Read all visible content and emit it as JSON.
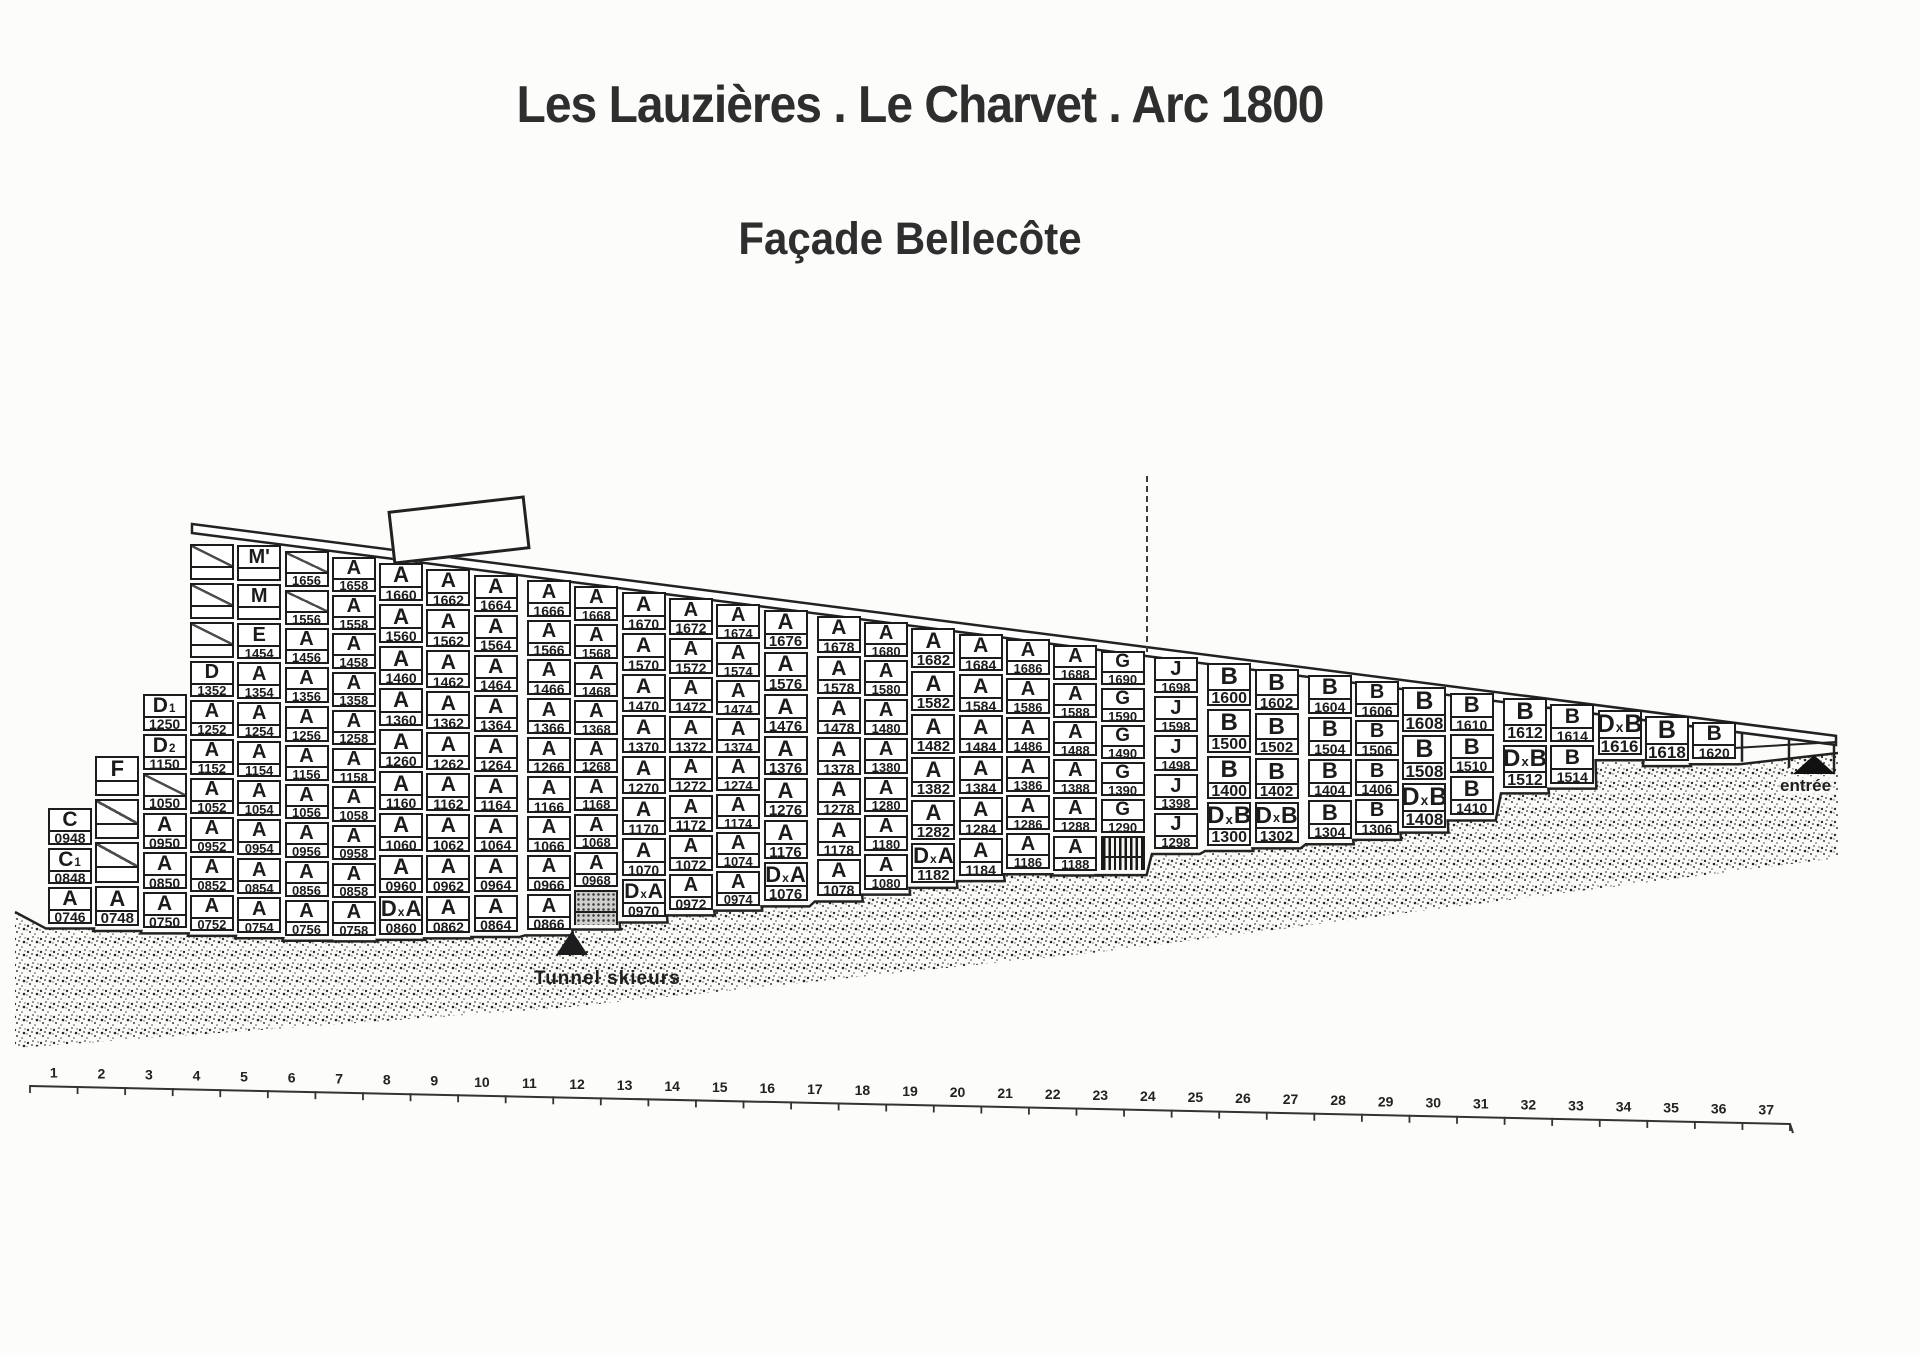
{
  "title": "Les Lauzières . Le Charvet . Arc 1800",
  "subtitle": "Façade Bellecôte",
  "annotations": {
    "tunnel_label": "Tunnel skieurs",
    "entree_label": "entrée"
  },
  "ruler": {
    "first": 1,
    "last": 37
  },
  "building": {
    "name": "Façade Bellecôte unit grid",
    "columns": [
      {
        "id": "46",
        "cells": [
          {
            "t": "C",
            "n": "0948"
          },
          {
            "t": "C1",
            "n": "0848"
          },
          {
            "t": "A",
            "n": "0746"
          }
        ]
      },
      {
        "id": "48",
        "cells": [
          {
            "t": "F",
            "n": ""
          },
          {
            "t": "",
            "n": "",
            "d": 1
          },
          {
            "t": "",
            "n": "",
            "d": 1
          },
          {
            "t": "A",
            "n": "0748"
          }
        ]
      },
      {
        "id": "50",
        "cells": [
          {
            "t": "D1",
            "n": "1250"
          },
          {
            "t": "D2",
            "n": "1150"
          },
          {
            "t": "",
            "n": "1050",
            "d": 1
          },
          {
            "t": "A",
            "n": "0950"
          },
          {
            "t": "A",
            "n": "0850"
          },
          {
            "t": "A",
            "n": "0750"
          }
        ]
      },
      {
        "id": "52",
        "cells": [
          {
            "t": "",
            "n": "",
            "d": 1
          },
          {
            "t": "",
            "n": "",
            "d": 1
          },
          {
            "t": "",
            "n": "",
            "d": 1
          },
          {
            "t": "D",
            "n": "1352"
          },
          {
            "t": "A",
            "n": "1252"
          },
          {
            "t": "A",
            "n": "1152"
          },
          {
            "t": "A",
            "n": "1052"
          },
          {
            "t": "A",
            "n": "0952"
          },
          {
            "t": "A",
            "n": "0852"
          },
          {
            "t": "A",
            "n": "0752"
          }
        ]
      },
      {
        "id": "54",
        "cells": [
          {
            "t": "M'",
            "n": ""
          },
          {
            "t": "M",
            "n": ""
          },
          {
            "t": "E",
            "n": "1454"
          },
          {
            "t": "A",
            "n": "1354"
          },
          {
            "t": "A",
            "n": "1254"
          },
          {
            "t": "A",
            "n": "1154"
          },
          {
            "t": "A",
            "n": "1054"
          },
          {
            "t": "A",
            "n": "0954"
          },
          {
            "t": "A",
            "n": "0854"
          },
          {
            "t": "A",
            "n": "0754"
          }
        ]
      },
      {
        "id": "56",
        "cells": [
          {
            "t": "",
            "n": "1656",
            "d": 1
          },
          {
            "t": "",
            "n": "1556",
            "d": 1
          },
          {
            "t": "A",
            "n": "1456"
          },
          {
            "t": "A",
            "n": "1356"
          },
          {
            "t": "A",
            "n": "1256"
          },
          {
            "t": "A",
            "n": "1156"
          },
          {
            "t": "A",
            "n": "1056"
          },
          {
            "t": "A",
            "n": "0956"
          },
          {
            "t": "A",
            "n": "0856"
          },
          {
            "t": "A",
            "n": "0756"
          }
        ]
      },
      {
        "id": "58",
        "cells": [
          {
            "t": "A",
            "n": "1658"
          },
          {
            "t": "A",
            "n": "1558"
          },
          {
            "t": "A",
            "n": "1458"
          },
          {
            "t": "A",
            "n": "1358"
          },
          {
            "t": "A",
            "n": "1258"
          },
          {
            "t": "A",
            "n": "1158"
          },
          {
            "t": "A",
            "n": "1058"
          },
          {
            "t": "A",
            "n": "0958"
          },
          {
            "t": "A",
            "n": "0858"
          },
          {
            "t": "A",
            "n": "0758"
          }
        ]
      },
      {
        "id": "60",
        "cells": [
          {
            "t": "A",
            "n": "1660"
          },
          {
            "t": "A",
            "n": "1560"
          },
          {
            "t": "A",
            "n": "1460"
          },
          {
            "t": "A",
            "n": "1360"
          },
          {
            "t": "A",
            "n": "1260"
          },
          {
            "t": "A",
            "n": "1160"
          },
          {
            "t": "A",
            "n": "1060"
          },
          {
            "t": "A",
            "n": "0960"
          },
          {
            "t": "DxA",
            "n": "0860"
          }
        ]
      },
      {
        "id": "62",
        "cells": [
          {
            "t": "A",
            "n": "1662"
          },
          {
            "t": "A",
            "n": "1562"
          },
          {
            "t": "A",
            "n": "1462"
          },
          {
            "t": "A",
            "n": "1362"
          },
          {
            "t": "A",
            "n": "1262"
          },
          {
            "t": "A",
            "n": "1162"
          },
          {
            "t": "A",
            "n": "1062"
          },
          {
            "t": "A",
            "n": "0962"
          },
          {
            "t": "A",
            "n": "0862"
          }
        ]
      },
      {
        "id": "64",
        "cells": [
          {
            "t": "A",
            "n": "1664"
          },
          {
            "t": "A",
            "n": "1564"
          },
          {
            "t": "A",
            "n": "1464"
          },
          {
            "t": "A",
            "n": "1364"
          },
          {
            "t": "A",
            "n": "1264"
          },
          {
            "t": "A",
            "n": "1164"
          },
          {
            "t": "A",
            "n": "1064"
          },
          {
            "t": "A",
            "n": "0964"
          },
          {
            "t": "A",
            "n": "0864"
          }
        ]
      },
      {
        "id": "66",
        "sep": 1,
        "cells": [
          {
            "t": "A",
            "n": "1666"
          },
          {
            "t": "A",
            "n": "1566"
          },
          {
            "t": "A",
            "n": "1466"
          },
          {
            "t": "A",
            "n": "1366"
          },
          {
            "t": "A",
            "n": "1266"
          },
          {
            "t": "A",
            "n": "1166"
          },
          {
            "t": "A",
            "n": "1066"
          },
          {
            "t": "A",
            "n": "0966"
          },
          {
            "t": "A",
            "n": "0866"
          }
        ]
      },
      {
        "id": "68",
        "cells": [
          {
            "t": "A",
            "n": "1668"
          },
          {
            "t": "A",
            "n": "1568"
          },
          {
            "t": "A",
            "n": "1468"
          },
          {
            "t": "A",
            "n": "1368"
          },
          {
            "t": "A",
            "n": "1268"
          },
          {
            "t": "A",
            "n": "1168"
          },
          {
            "t": "A",
            "n": "1068"
          },
          {
            "t": "A",
            "n": "0968"
          },
          {
            "t": "",
            "n": "",
            "f": "stipple"
          }
        ]
      },
      {
        "id": "70",
        "cells": [
          {
            "t": "A",
            "n": "1670"
          },
          {
            "t": "A",
            "n": "1570"
          },
          {
            "t": "A",
            "n": "1470"
          },
          {
            "t": "A",
            "n": "1370"
          },
          {
            "t": "A",
            "n": "1270"
          },
          {
            "t": "A",
            "n": "1170"
          },
          {
            "t": "A",
            "n": "1070"
          },
          {
            "t": "DxA",
            "n": "0970"
          }
        ]
      },
      {
        "id": "72",
        "cells": [
          {
            "t": "A",
            "n": "1672"
          },
          {
            "t": "A",
            "n": "1572"
          },
          {
            "t": "A",
            "n": "1472"
          },
          {
            "t": "A",
            "n": "1372"
          },
          {
            "t": "A",
            "n": "1272"
          },
          {
            "t": "A",
            "n": "1172"
          },
          {
            "t": "A",
            "n": "1072"
          },
          {
            "t": "A",
            "n": "0972"
          }
        ]
      },
      {
        "id": "74",
        "cells": [
          {
            "t": "A",
            "n": "1674"
          },
          {
            "t": "A",
            "n": "1574"
          },
          {
            "t": "A",
            "n": "1474"
          },
          {
            "t": "A",
            "n": "1374"
          },
          {
            "t": "A",
            "n": "1274"
          },
          {
            "t": "A",
            "n": "1174"
          },
          {
            "t": "A",
            "n": "1074"
          },
          {
            "t": "A",
            "n": "0974"
          }
        ]
      },
      {
        "id": "76",
        "cells": [
          {
            "t": "A",
            "n": "1676"
          },
          {
            "t": "A",
            "n": "1576"
          },
          {
            "t": "A",
            "n": "1476"
          },
          {
            "t": "A",
            "n": "1376"
          },
          {
            "t": "A",
            "n": "1276"
          },
          {
            "t": "A",
            "n": "1176"
          },
          {
            "t": "DxA",
            "n": "1076"
          }
        ]
      },
      {
        "id": "78",
        "sep": 1,
        "cells": [
          {
            "t": "A",
            "n": "1678"
          },
          {
            "t": "A",
            "n": "1578"
          },
          {
            "t": "A",
            "n": "1478"
          },
          {
            "t": "A",
            "n": "1378"
          },
          {
            "t": "A",
            "n": "1278"
          },
          {
            "t": "A",
            "n": "1178"
          },
          {
            "t": "A",
            "n": "1078"
          }
        ]
      },
      {
        "id": "80",
        "cells": [
          {
            "t": "A",
            "n": "1680"
          },
          {
            "t": "A",
            "n": "1580"
          },
          {
            "t": "A",
            "n": "1480"
          },
          {
            "t": "A",
            "n": "1380"
          },
          {
            "t": "A",
            "n": "1280"
          },
          {
            "t": "A",
            "n": "1180"
          },
          {
            "t": "A",
            "n": "1080"
          }
        ]
      },
      {
        "id": "82",
        "cells": [
          {
            "t": "A",
            "n": "1682"
          },
          {
            "t": "A",
            "n": "1582"
          },
          {
            "t": "A",
            "n": "1482"
          },
          {
            "t": "A",
            "n": "1382"
          },
          {
            "t": "A",
            "n": "1282"
          },
          {
            "t": "DxA",
            "n": "1182"
          }
        ]
      },
      {
        "id": "84",
        "cells": [
          {
            "t": "A",
            "n": "1684"
          },
          {
            "t": "A",
            "n": "1584"
          },
          {
            "t": "A",
            "n": "1484"
          },
          {
            "t": "A",
            "n": "1384"
          },
          {
            "t": "A",
            "n": "1284"
          },
          {
            "t": "A",
            "n": "1184"
          }
        ]
      },
      {
        "id": "86",
        "cells": [
          {
            "t": "A",
            "n": "1686"
          },
          {
            "t": "A",
            "n": "1586"
          },
          {
            "t": "A",
            "n": "1486"
          },
          {
            "t": "A",
            "n": "1386"
          },
          {
            "t": "A",
            "n": "1286"
          },
          {
            "t": "A",
            "n": "1186"
          }
        ]
      },
      {
        "id": "88",
        "cells": [
          {
            "t": "A",
            "n": "1688"
          },
          {
            "t": "A",
            "n": "1588"
          },
          {
            "t": "A",
            "n": "1488"
          },
          {
            "t": "A",
            "n": "1388"
          },
          {
            "t": "A",
            "n": "1288"
          },
          {
            "t": "A",
            "n": "1188"
          }
        ]
      },
      {
        "id": "90",
        "cells": [
          {
            "t": "G",
            "n": "1690"
          },
          {
            "t": "G",
            "n": "1590"
          },
          {
            "t": "G",
            "n": "1490"
          },
          {
            "t": "G",
            "n": "1390"
          },
          {
            "t": "G",
            "n": "1290"
          },
          {
            "t": "",
            "n": "",
            "f": "stripes"
          }
        ]
      },
      {
        "id": "98",
        "sep": 1,
        "cells": [
          {
            "t": "J",
            "n": "1698"
          },
          {
            "t": "J",
            "n": "1598"
          },
          {
            "t": "J",
            "n": "1498"
          },
          {
            "t": "J",
            "n": "1398"
          },
          {
            "t": "J",
            "n": "1298"
          }
        ]
      },
      {
        "id": "00",
        "sep": 1,
        "cells": [
          {
            "t": "B",
            "n": "1600"
          },
          {
            "t": "B",
            "n": "1500"
          },
          {
            "t": "B",
            "n": "1400"
          },
          {
            "t": "DxB",
            "n": "1300"
          }
        ]
      },
      {
        "id": "02",
        "cells": [
          {
            "t": "B",
            "n": "1602"
          },
          {
            "t": "B",
            "n": "1502"
          },
          {
            "t": "B",
            "n": "1402"
          },
          {
            "t": "DxB",
            "n": "1302"
          }
        ]
      },
      {
        "id": "04",
        "sep": 1,
        "cells": [
          {
            "t": "B",
            "n": "1604"
          },
          {
            "t": "B",
            "n": "1504"
          },
          {
            "t": "B",
            "n": "1404"
          },
          {
            "t": "B",
            "n": "1304"
          }
        ]
      },
      {
        "id": "06",
        "cells": [
          {
            "t": "B",
            "n": "1606"
          },
          {
            "t": "B",
            "n": "1506"
          },
          {
            "t": "B",
            "n": "1406"
          },
          {
            "t": "B",
            "n": "1306"
          }
        ]
      },
      {
        "id": "08",
        "cells": [
          {
            "t": "B",
            "n": "1608"
          },
          {
            "t": "B",
            "n": "1508"
          },
          {
            "t": "DxB",
            "n": "1408"
          }
        ]
      },
      {
        "id": "10",
        "cells": [
          {
            "t": "B",
            "n": "1610"
          },
          {
            "t": "B",
            "n": "1510"
          },
          {
            "t": "B",
            "n": "1410"
          }
        ]
      },
      {
        "id": "12",
        "sep": 1,
        "cells": [
          {
            "t": "B",
            "n": "1612"
          },
          {
            "t": "DxB",
            "n": "1512"
          }
        ]
      },
      {
        "id": "14",
        "cells": [
          {
            "t": "B",
            "n": "1614"
          },
          {
            "t": "B",
            "n": "1514"
          }
        ]
      },
      {
        "id": "16",
        "cells": [
          {
            "t": "DxB",
            "n": "1616"
          }
        ]
      },
      {
        "id": "18",
        "cells": [
          {
            "t": "B",
            "n": "1618"
          }
        ]
      },
      {
        "id": "20",
        "cells": [
          {
            "t": "B",
            "n": "1620"
          }
        ]
      }
    ]
  }
}
